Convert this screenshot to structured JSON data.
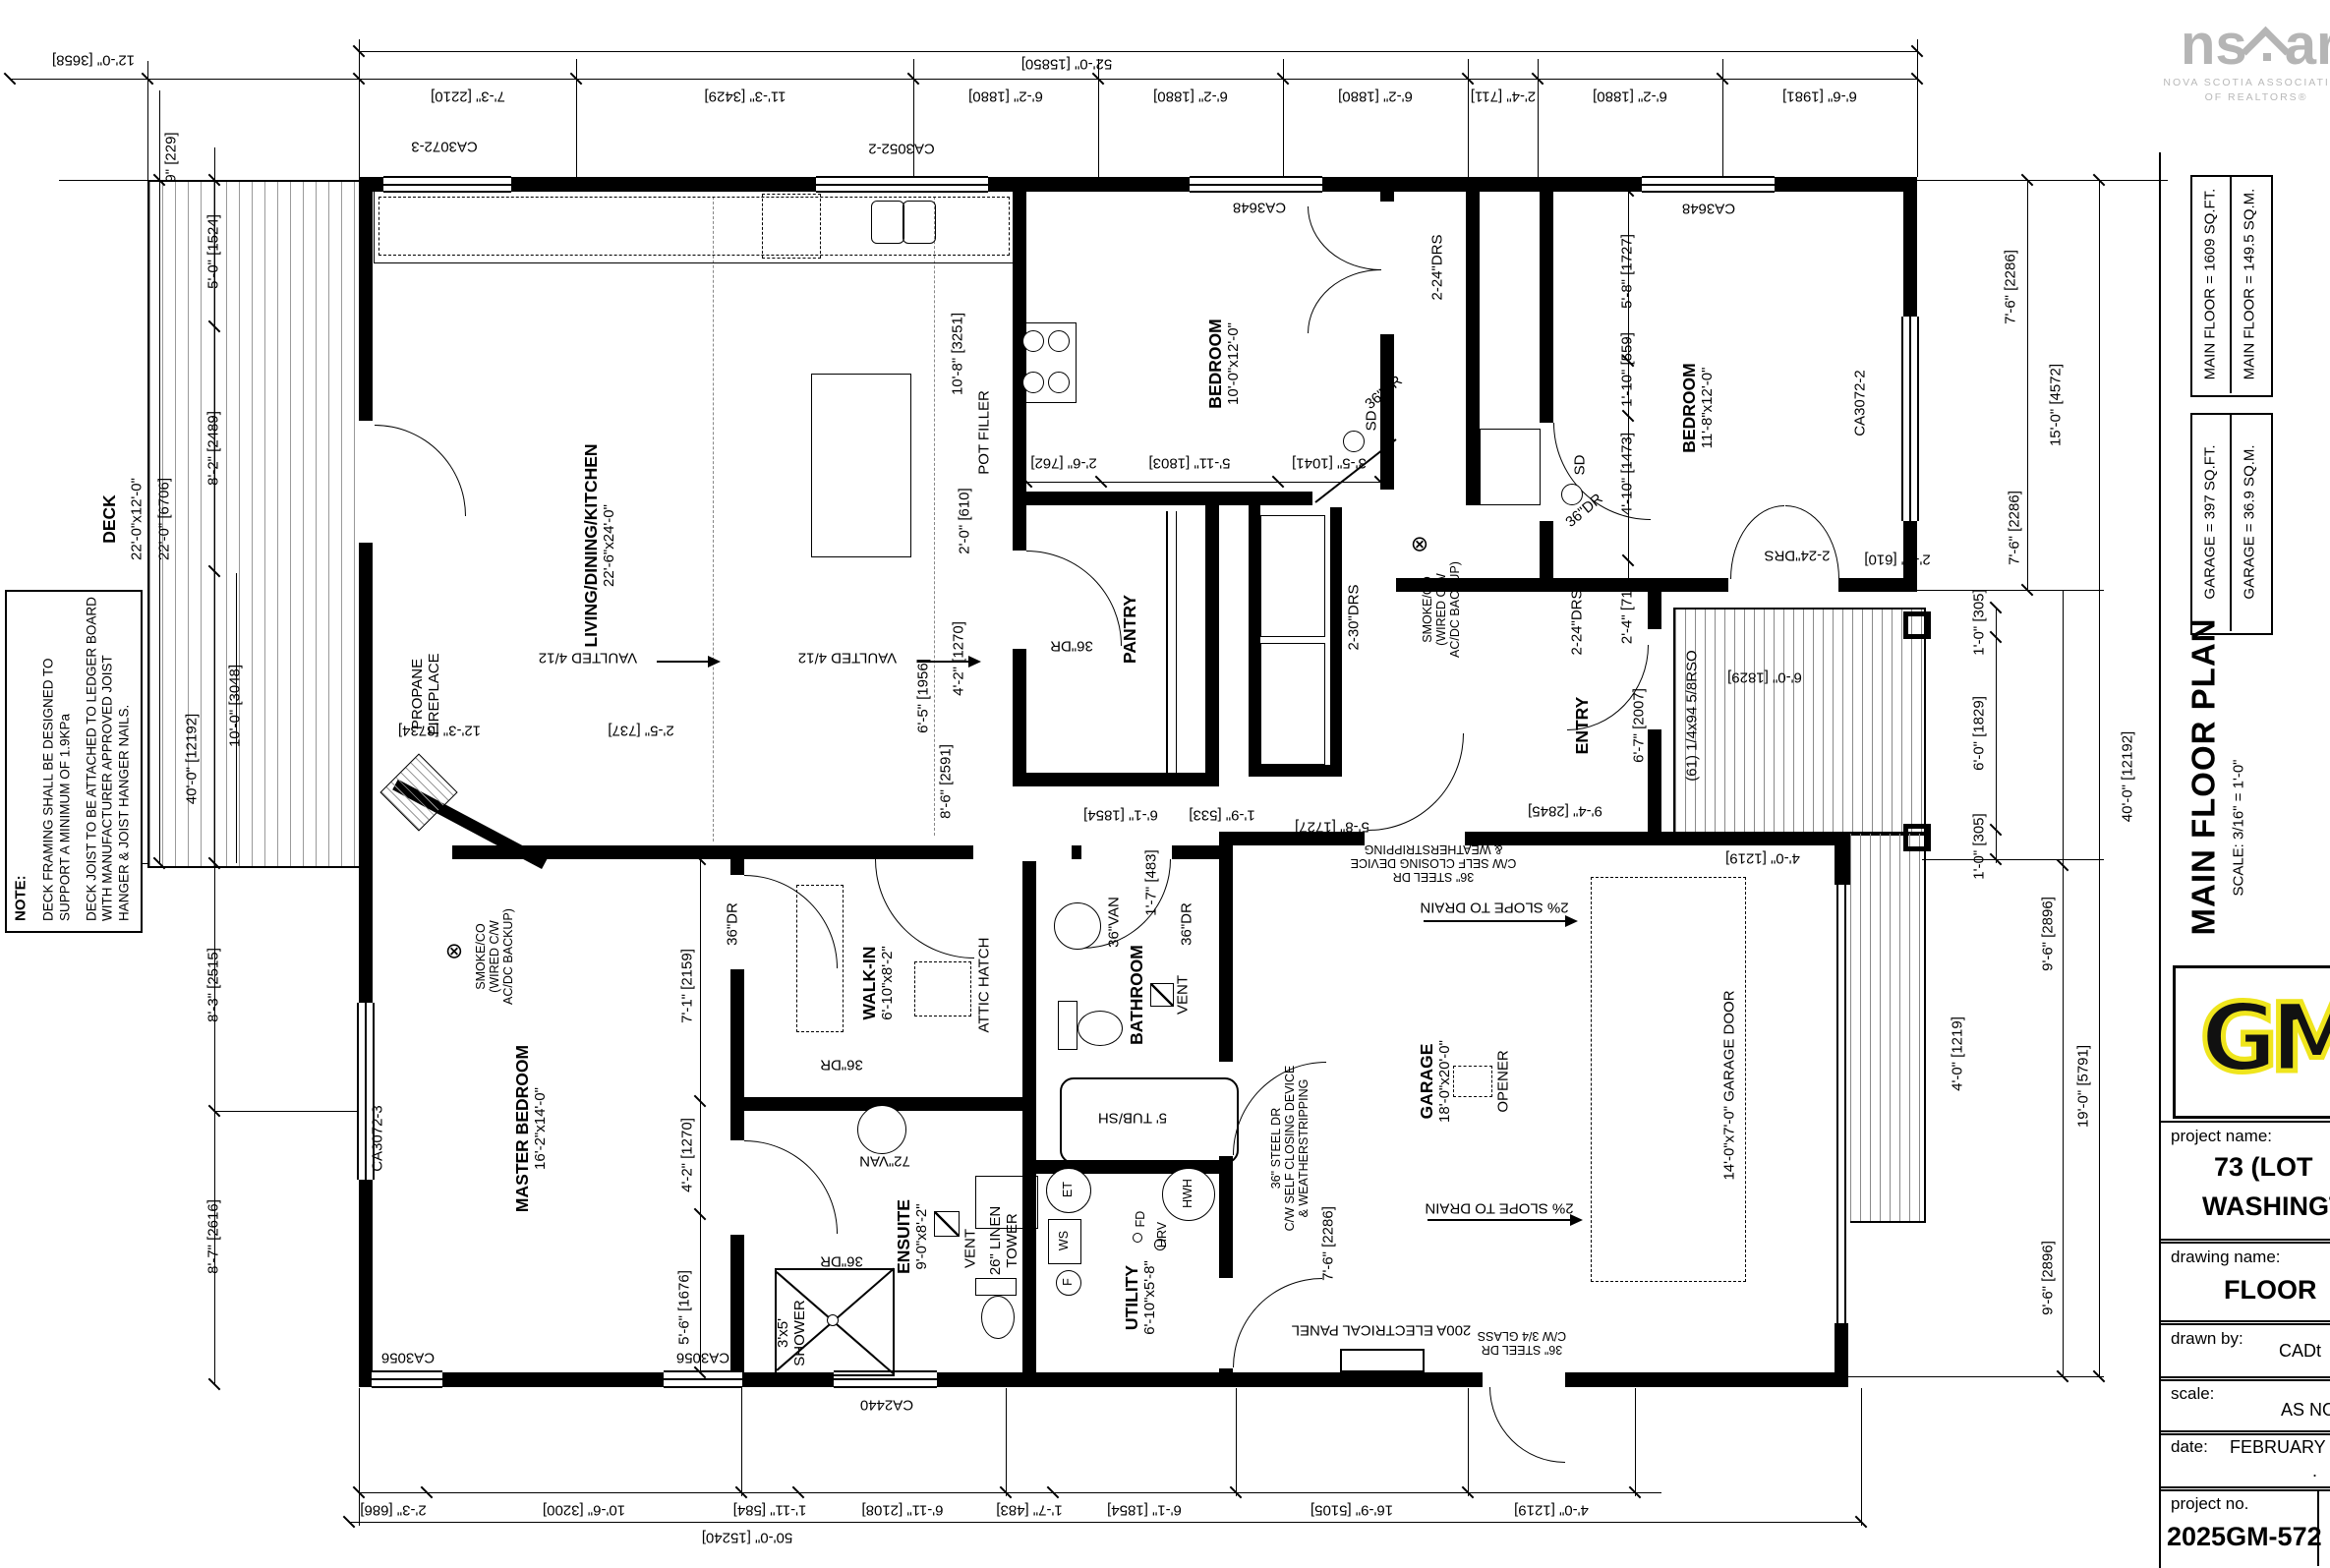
{
  "logo": {
    "ns": "ns",
    "ar": "ar",
    "caption1": "NOVA SCOTIA ASSOCIATION",
    "caption2": "OF REALTORS®"
  },
  "titleblock": {
    "area_main_ft": "MAIN FLOOR = 1609 SQ.FT.",
    "area_main_m": "MAIN FLOOR = 149.5 SQ.M.",
    "area_garage_ft": "GARAGE = 397 SQ.FT.",
    "area_garage_m": "GARAGE = 36.9 SQ.M.",
    "title": "MAIN FLOOR PLAN",
    "scale_note": "SCALE: 3/16\" = 1'-0\"",
    "gm": "GM",
    "project_name_label": "project name:",
    "project_name_line1": "73 (LOT",
    "project_name_line2": "WASHINGTO",
    "drawing_name_label": "drawing name:",
    "drawing_name": "FLOOR",
    "drawn_by_label": "drawn by:",
    "drawn_by": "CADt",
    "scale_label": "scale:",
    "scale_value": "AS NO",
    "date_label": "date:",
    "date_value": "FEBRUARY",
    "dot": ".",
    "project_no_label": "project no.",
    "project_no": "2025GM-572"
  },
  "note": {
    "heading": "NOTE:",
    "p1": "DECK FRAMING SHALL BE DESIGNED TO SUPPORT A MINIMUM OF 1.9KPa",
    "p2": "DECK JOIST TO BE ATTACHED TO LEDGER BOARD WITH MANUFACTURER APPROVED JOIST HANGER & JOIST HANGER NAILS."
  },
  "rooms": {
    "living": {
      "name": "LIVING/DINING/KITCHEN",
      "size": "22'-6\"x24'-0\""
    },
    "bedroom1": {
      "name": "BEDROOM",
      "size": "10'-0\"x12'-0\""
    },
    "bedroom2": {
      "name": "BEDROOM",
      "size": "11'-8\"x12'-0\""
    },
    "master": {
      "name": "MASTER BEDROOM",
      "size": "16'-2\"x14'-0\""
    },
    "walkin": {
      "name": "WALK-IN",
      "size": "6'-10\"x8'-2\""
    },
    "ensuite": {
      "name": "ENSUITE",
      "size": "9'-0\"x8'-2\""
    },
    "bathroom": {
      "name": "BATHROOM"
    },
    "utility": {
      "name": "UTILITY",
      "size": "6'-10\"x5'-8\""
    },
    "garage": {
      "name": "GARAGE",
      "size": "18'-0\"x20'-0\""
    },
    "pantry": {
      "name": "PANTRY"
    },
    "entry": {
      "name": "ENTRY"
    },
    "deck": {
      "name": "DECK",
      "size": "22'-0\"x12'-0\""
    }
  },
  "doors": {
    "d36": "36\"DR",
    "d16": "16\"DR",
    "drs24": "2-24\"DRS",
    "drs30": "2-30\"DRS",
    "sd": "SD",
    "smoke_sym": "⊗"
  },
  "windows": {
    "ca3052_2": "CA3052-2",
    "ca3072_3": "CA3072-3",
    "ca3648": "CA3648",
    "ca3072_2": "CA3072-2",
    "ca3056": "CA3056",
    "ca2440": "CA2440"
  },
  "features": {
    "vaulted": "VAULTED 4/12",
    "fp1": "PROPANE",
    "fp2": "FIREPLACE",
    "pot": "POT FILLER",
    "attic": "ATTIC HATCH",
    "van72": "72\"VAN",
    "van36": "36\"VAN",
    "vent": "VENT",
    "tub": "5' TUB/SH",
    "shower1": "3'x5'",
    "shower2": "SHOWER",
    "linen1": "26\" LINEN",
    "linen2": "TOWER",
    "smoke1": "SMOKE/CO",
    "smoke2": "(WIRED C/W",
    "smoke3": "AC/DC BACKUP)",
    "opener": "OPENER",
    "slope": "2% SLOPE TO DRAIN",
    "gardoor": "14'-0\"x7'-0\" GARAGE DOOR",
    "panel": "200A ELECTRICAL PANEL",
    "steel1": "36\" STEEL DR",
    "steel2": "C/W SELF CLOSING DEVICE",
    "steel3": "& WEATHERSTRIPPING",
    "glass2": "C/W 3/4 GLASS",
    "rso": "(61) 1/4x94 5/8RSO",
    "et": "ET",
    "ws": "WS",
    "f": "F",
    "fd": "FD",
    "hrv": "HRV",
    "hwh": "HWH"
  },
  "dim": {
    "t_deck": "12'-0\" [3658]",
    "t_all": "52'-0\" [15850]",
    "t1": "7'-3\" [2210]",
    "t2": "11'-3\" [3429]",
    "t3": "6'-2\" [1880]",
    "t4": "2'-4\" [711]",
    "t5": "6'-6\" [1981]",
    "b_all": "50'-0\" [15240]",
    "b0": "2'-3\" [686]",
    "b1": "10'-6\" [3200]",
    "b2": "1'-11\" [584]",
    "b3": "6'-11\" [2108]",
    "b4": "1'-7\" [483]",
    "b5": "6'-1\" [1854]",
    "b6": "16'-9\" [5105]",
    "b7": "4'-0\" [1219]",
    "l0": "9\" [229]",
    "l1": "5'-0\" [1524]",
    "l2": "8'-2\" [2489]",
    "l3": "22'-0\" [6706]",
    "l4": "40'-0\" [12192]",
    "l5": "10'-0\" [3048]",
    "l6": "8'-3\" [2515]",
    "l7": "8'-7\" [2616]",
    "l8": "12'-3\" [3734]",
    "l9": "2'-5\" [737]",
    "r0": "7'-6\" [2286]",
    "r1": "15'-0\" [4572]",
    "r4": "19'-0\" [5791]",
    "r5": "9'-6\" [2896]",
    "r7": "1'-0\" [305]",
    "r8": "6'-0\" [1829]",
    "i0": "10'-8\" [3251]",
    "i1": "2'-0\" [610]",
    "i2": "4'-2\" [1270]",
    "i3": "2'-6\" [762]",
    "i4": "5'-11\" [1803]",
    "i5": "3'-5\" [1041]",
    "i6": "5'-8\" [1727]",
    "i7": "1'-10\" [559]",
    "i8": "4'-10\" [1473]",
    "i9": "2'-4\" [711]",
    "i10": "6'-7\" [2007]",
    "i11": "6'-5\" [1956]",
    "i12": "8'-6\" [2591]",
    "i13": "7'-1\" [2159]",
    "i14": "5'-6\" [1676]",
    "i16": "6'-1\" [1854]",
    "i17": "1'-9\" [533]",
    "i18": "9'-4\" [2845]"
  }
}
